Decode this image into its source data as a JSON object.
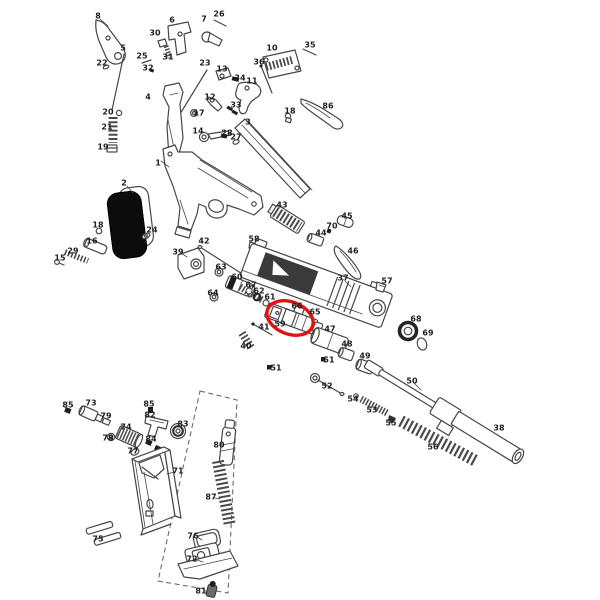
{
  "diagram": {
    "type": "exploded-parts-diagram",
    "description": "Exploded parts diagram of a pistol with numbered components; one nozzle-assembly part group is circled in red; magazine internals are enclosed by a dashed outline",
    "background_color": "#ffffff",
    "line_color": "#474747",
    "label_color": "#1f1f1f",
    "highlight": {
      "color": "#e01313",
      "cx": 290,
      "cy": 318,
      "rx": 24,
      "ry": 16,
      "rotation_deg": 21
    },
    "dashed_outline": {
      "points": "200,391 237,400 228,593 158,581"
    },
    "part_labels": [
      {
        "n": "8",
        "x": 98,
        "y": 16
      },
      {
        "n": "26",
        "x": 219,
        "y": 14
      },
      {
        "n": "7",
        "x": 204,
        "y": 19
      },
      {
        "n": "6",
        "x": 172,
        "y": 20
      },
      {
        "n": "30",
        "x": 155,
        "y": 33
      },
      {
        "n": "35",
        "x": 310,
        "y": 45
      },
      {
        "n": "5",
        "x": 123,
        "y": 48
      },
      {
        "n": "10",
        "x": 272,
        "y": 48
      },
      {
        "n": "25",
        "x": 142,
        "y": 56
      },
      {
        "n": "31",
        "x": 168,
        "y": 57
      },
      {
        "n": "36",
        "x": 259,
        "y": 62
      },
      {
        "n": "22",
        "x": 102,
        "y": 63
      },
      {
        "n": "23",
        "x": 205,
        "y": 63
      },
      {
        "n": "13",
        "x": 222,
        "y": 69
      },
      {
        "n": "32",
        "x": 148,
        "y": 68
      },
      {
        "n": "34",
        "x": 240,
        "y": 78
      },
      {
        "n": "11",
        "x": 252,
        "y": 81
      },
      {
        "n": "4",
        "x": 148,
        "y": 97
      },
      {
        "n": "12",
        "x": 210,
        "y": 97
      },
      {
        "n": "33",
        "x": 236,
        "y": 105
      },
      {
        "n": "86",
        "x": 328,
        "y": 106
      },
      {
        "n": "18",
        "x": 290,
        "y": 111
      },
      {
        "n": "20",
        "x": 108,
        "y": 112
      },
      {
        "n": "17",
        "x": 199,
        "y": 113
      },
      {
        "n": "3",
        "x": 248,
        "y": 122
      },
      {
        "n": "21",
        "x": 107,
        "y": 127
      },
      {
        "n": "14",
        "x": 198,
        "y": 131
      },
      {
        "n": "28",
        "x": 227,
        "y": 133
      },
      {
        "n": "27",
        "x": 236,
        "y": 137
      },
      {
        "n": "19",
        "x": 103,
        "y": 147
      },
      {
        "n": "1",
        "x": 158,
        "y": 163
      },
      {
        "n": "2",
        "x": 124,
        "y": 183
      },
      {
        "n": "43",
        "x": 282,
        "y": 205
      },
      {
        "n": "45",
        "x": 347,
        "y": 216
      },
      {
        "n": "18",
        "x": 98,
        "y": 225
      },
      {
        "n": "70",
        "x": 332,
        "y": 226
      },
      {
        "n": "24",
        "x": 152,
        "y": 230
      },
      {
        "n": "44",
        "x": 321,
        "y": 233
      },
      {
        "n": "58",
        "x": 254,
        "y": 239
      },
      {
        "n": "42",
        "x": 204,
        "y": 241
      },
      {
        "n": "16",
        "x": 92,
        "y": 241
      },
      {
        "n": "46",
        "x": 353,
        "y": 251
      },
      {
        "n": "39",
        "x": 178,
        "y": 252
      },
      {
        "n": "29",
        "x": 73,
        "y": 251
      },
      {
        "n": "15",
        "x": 60,
        "y": 258
      },
      {
        "n": "63",
        "x": 221,
        "y": 267
      },
      {
        "n": "60",
        "x": 237,
        "y": 277
      },
      {
        "n": "37",
        "x": 343,
        "y": 278
      },
      {
        "n": "57",
        "x": 387,
        "y": 281
      },
      {
        "n": "67",
        "x": 251,
        "y": 285
      },
      {
        "n": "62",
        "x": 259,
        "y": 291
      },
      {
        "n": "64",
        "x": 213,
        "y": 293
      },
      {
        "n": "61",
        "x": 270,
        "y": 297
      },
      {
        "n": "66",
        "x": 297,
        "y": 306
      },
      {
        "n": "65",
        "x": 315,
        "y": 312
      },
      {
        "n": "68",
        "x": 416,
        "y": 319
      },
      {
        "n": "59",
        "x": 280,
        "y": 324
      },
      {
        "n": "41",
        "x": 264,
        "y": 327
      },
      {
        "n": "47",
        "x": 330,
        "y": 329
      },
      {
        "n": "69",
        "x": 428,
        "y": 333
      },
      {
        "n": "40",
        "x": 246,
        "y": 346
      },
      {
        "n": "48",
        "x": 347,
        "y": 344
      },
      {
        "n": "49",
        "x": 365,
        "y": 356
      },
      {
        "n": "51",
        "x": 329,
        "y": 360
      },
      {
        "n": "51",
        "x": 276,
        "y": 368
      },
      {
        "n": "52",
        "x": 327,
        "y": 386
      },
      {
        "n": "50",
        "x": 412,
        "y": 381
      },
      {
        "n": "54",
        "x": 353,
        "y": 399
      },
      {
        "n": "53",
        "x": 372,
        "y": 410
      },
      {
        "n": "55",
        "x": 391,
        "y": 423
      },
      {
        "n": "38",
        "x": 499,
        "y": 428
      },
      {
        "n": "56",
        "x": 433,
        "y": 447
      },
      {
        "n": "85",
        "x": 68,
        "y": 405
      },
      {
        "n": "73",
        "x": 91,
        "y": 403
      },
      {
        "n": "85",
        "x": 149,
        "y": 404
      },
      {
        "n": "79",
        "x": 106,
        "y": 416
      },
      {
        "n": "82",
        "x": 150,
        "y": 415
      },
      {
        "n": "83",
        "x": 183,
        "y": 424
      },
      {
        "n": "74",
        "x": 126,
        "y": 427
      },
      {
        "n": "78",
        "x": 108,
        "y": 438
      },
      {
        "n": "84",
        "x": 151,
        "y": 439
      },
      {
        "n": "80",
        "x": 219,
        "y": 445
      },
      {
        "n": "77",
        "x": 133,
        "y": 451
      },
      {
        "n": "71",
        "x": 178,
        "y": 471
      },
      {
        "n": "87",
        "x": 211,
        "y": 497
      },
      {
        "n": "76",
        "x": 193,
        "y": 536
      },
      {
        "n": "75",
        "x": 98,
        "y": 539
      },
      {
        "n": "72",
        "x": 192,
        "y": 559
      },
      {
        "n": "81",
        "x": 201,
        "y": 591
      }
    ]
  }
}
